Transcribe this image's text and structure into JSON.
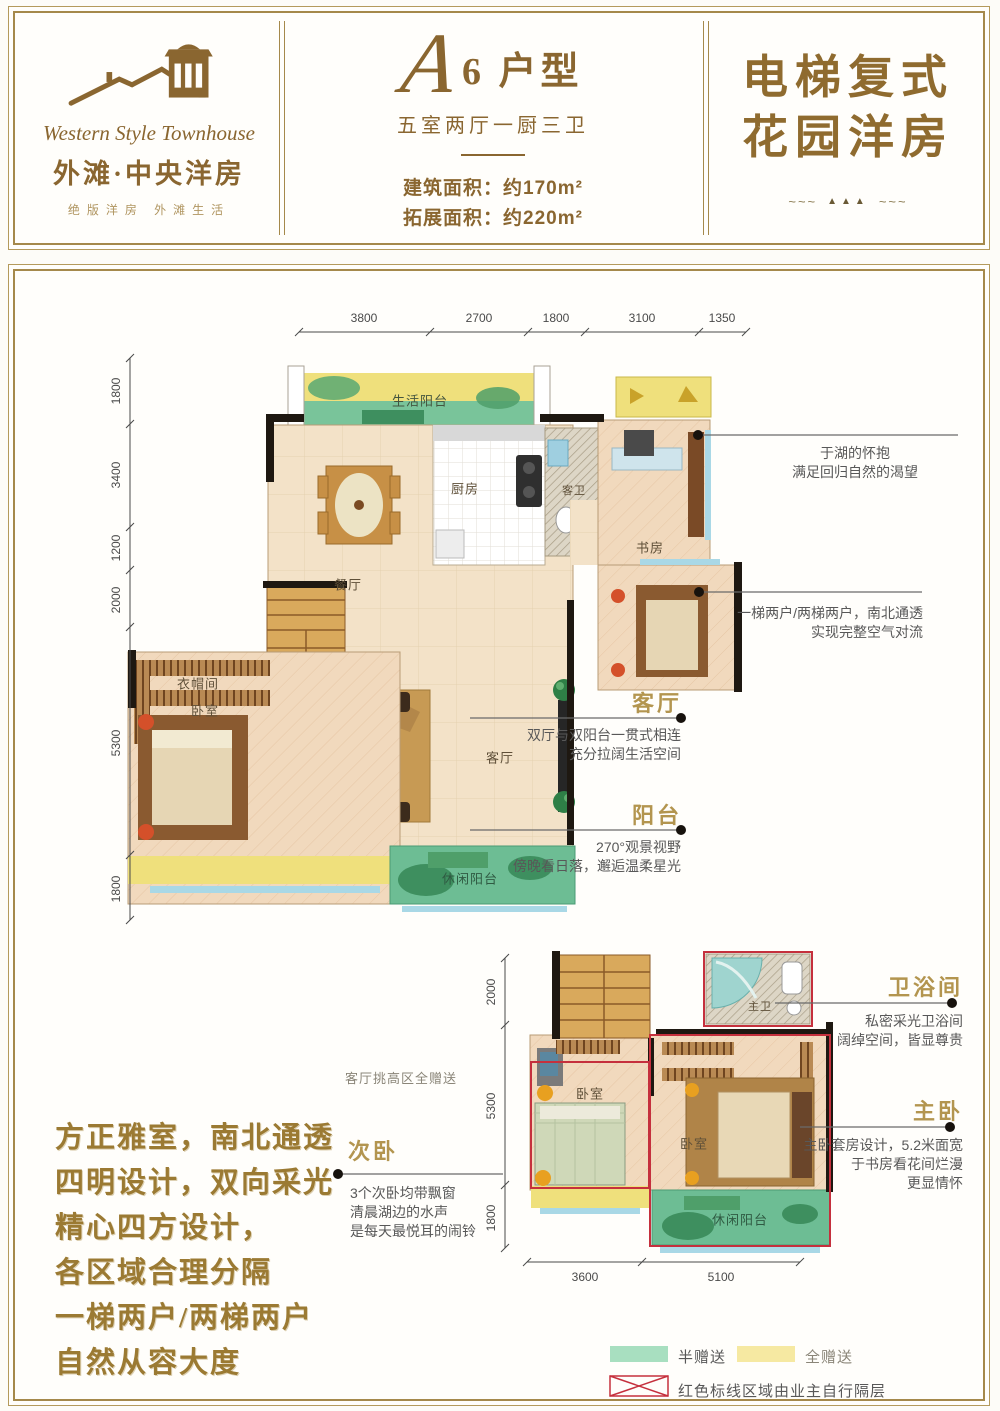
{
  "header": {
    "logo": {
      "name_en": "Western Style Townhouse",
      "name_cn": "外滩·中央洋房",
      "tagline": "绝版洋房  外滩生活"
    },
    "unit": {
      "letter": "A",
      "title": "6 户型",
      "layout": "五室两厅一厨三卫",
      "area_build": "建筑面积：约170m²",
      "area_expand": "拓展面积：约220m²"
    },
    "banner": {
      "line1": "电梯复式",
      "line2": "花园洋房",
      "ornament_wave": "~~~",
      "ornament_triangles": "▲▲▲"
    }
  },
  "plan1": {
    "dims_top": [
      "3800",
      "2700",
      "1800",
      "3100",
      "1350"
    ],
    "dims_left": [
      "1800",
      "3400",
      "1200",
      "2000",
      "5300",
      "1800"
    ],
    "rooms": {
      "life_balcony": "生活阳台",
      "dining": "餐厅",
      "kitchen": "厨房",
      "guest_bath": "客卫",
      "study": "书房",
      "cloakroom": "衣帽间",
      "bedroom": "卧室",
      "living": "客厅",
      "leisure_balcony": "休闲阳台"
    }
  },
  "plan2": {
    "dims_left": [
      "2000",
      "5300",
      "1800"
    ],
    "dims_bottom": [
      "3600",
      "5100"
    ],
    "rooms": {
      "master_bath": "主卫",
      "bedroom_left": "卧室",
      "bedroom_right": "卧室",
      "leisure_balcony": "休闲阳台"
    },
    "note": "客厅挑高区全赠送"
  },
  "annotations": {
    "lake": {
      "l1": "于湖的怀抱",
      "l2": "满足回归自然的渴望"
    },
    "vent": {
      "l1": "一梯两户/两梯两户，南北通透",
      "l2": "实现完整空气对流"
    },
    "living": {
      "title": "客厅",
      "l1": "双厅与双阳台一贯式相连",
      "l2": "充分拉阔生活空间"
    },
    "balcony": {
      "title": "阳台",
      "l1": "270°观景视野",
      "l2": "傍晚看日落，邂逅温柔星光"
    },
    "bathroom": {
      "title": "卫浴间",
      "l1": "私密采光卫浴间",
      "l2": "阔绰空间，皆显尊贵"
    },
    "master": {
      "title": "主卧",
      "l1": "主卧套房设计，5.2米面宽",
      "l2": "于书房看花间烂漫",
      "l3": "更显情怀"
    },
    "secondary": {
      "title": "次卧",
      "l1": "3个次卧均带飘窗",
      "l2": "清晨湖边的水声",
      "l3": "是每天最悦耳的闹铃"
    }
  },
  "slogan": {
    "lines": [
      "方正雅室，南北通透",
      "四明设计，双向采光",
      "精心四方设计，",
      "各区域合理分隔",
      "一梯两户/两梯两户",
      "自然从容大度"
    ]
  },
  "legend": {
    "half": "半赠送",
    "full": "全赠送",
    "red_note": "红色标线区域由业主自行隔层"
  },
  "colors": {
    "frame_gold": "#a5894b",
    "title_brown": "#8a6630",
    "half_green": "#a8dfc0",
    "full_yellow": "#f6e9a2",
    "red_line": "#c5303d"
  }
}
